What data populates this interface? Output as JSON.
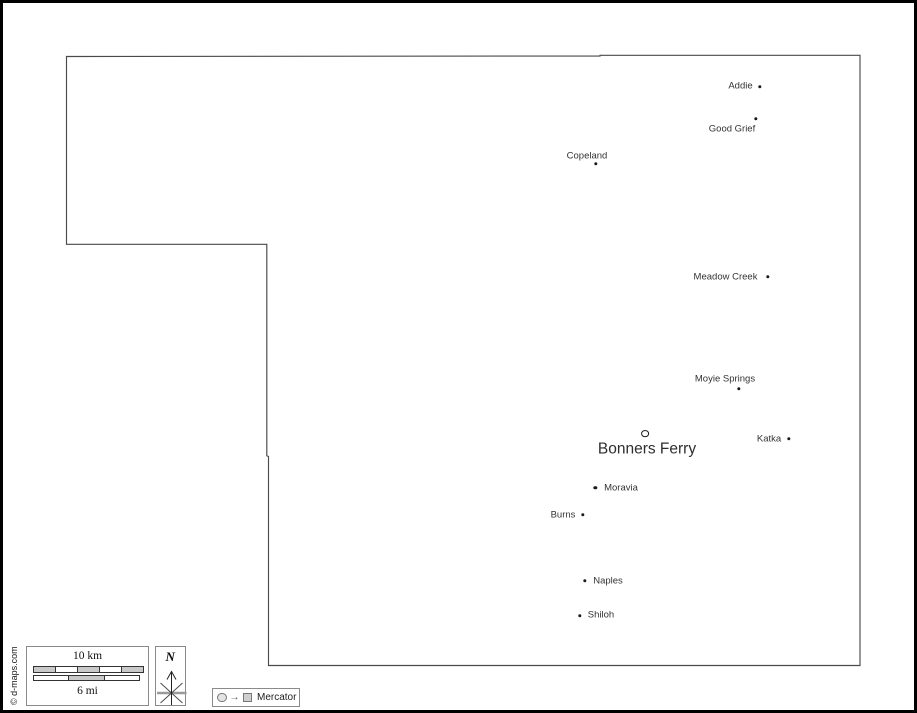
{
  "map": {
    "region_name": "Boundary county map",
    "cities": [
      {
        "name": "Addie",
        "dot_x": 757,
        "dot_y": 84,
        "label_x": 737.5,
        "label_y": 83
      },
      {
        "name": "Good Grief",
        "dot_x": 753,
        "dot_y": 116,
        "label_x": 729,
        "label_y": 126
      },
      {
        "name": "Copeland",
        "dot_x": 593,
        "dot_y": 161,
        "label_x": 584,
        "label_y": 152.5
      },
      {
        "name": "Meadow Creek",
        "dot_x": 765,
        "dot_y": 274,
        "label_x": 722.5,
        "label_y": 273.5
      },
      {
        "name": "Moyie Springs",
        "dot_x": 735.5,
        "dot_y": 386,
        "label_x": 722,
        "label_y": 375.5
      },
      {
        "name": "Bonners Ferry",
        "dot_x": 642,
        "dot_y": 430.5,
        "label_x": 644,
        "label_y": 445.5,
        "marker": "ring",
        "major": true
      },
      {
        "name": "Katka",
        "dot_x": 786,
        "dot_y": 436,
        "label_x": 766,
        "label_y": 435.5
      },
      {
        "name": "Moravia",
        "dot_x": 592.3,
        "dot_y": 485,
        "label_x": 618,
        "label_y": 485
      },
      {
        "name": "Burns",
        "dot_x": 579.5,
        "dot_y": 511.7,
        "label_x": 560,
        "label_y": 511.5
      },
      {
        "name": "Naples",
        "dot_x": 581.5,
        "dot_y": 577.7,
        "label_x": 605,
        "label_y": 577.5
      },
      {
        "name": "Shiloh",
        "dot_x": 576.5,
        "dot_y": 612.7,
        "label_x": 598,
        "label_y": 611.5
      }
    ]
  },
  "legend": {
    "scale": {
      "km_label": "10 km",
      "mi_label": "6 mi"
    },
    "north_label": "N",
    "projection_label": "Mercator"
  },
  "footer": {
    "copyright": "© d-maps.com"
  },
  "colors": {
    "frame_border": "#000000",
    "county_outline": "#4a4a4a",
    "label_text": "#333333",
    "legend_border": "#8a8a8a",
    "scale_gray": "#c9c9c9",
    "background": "#ffffff"
  }
}
